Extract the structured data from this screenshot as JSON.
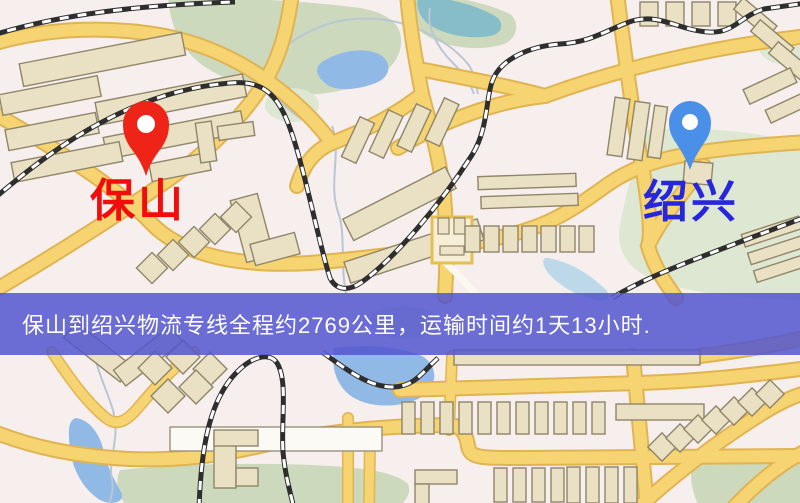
{
  "map": {
    "background_color": "#f6efee",
    "markers": {
      "origin": {
        "name": "保山",
        "pin_color": "#ee2419",
        "label_color": "#f20c0c"
      },
      "destination": {
        "name": "绍兴",
        "pin_color": "#4a90e8",
        "label_color": "#2626df"
      }
    },
    "banner": {
      "text": "保山到绍兴物流专线全程约2769公里，运输时间约1天13小时.",
      "background_color": "#5456cf",
      "text_color": "#ffffff"
    },
    "legend_colors": {
      "road": "#f6d472",
      "building": "#eae1c4",
      "water": "#90b9e6",
      "park": "#ccd9bd",
      "railway": "#2e2e2e"
    }
  }
}
